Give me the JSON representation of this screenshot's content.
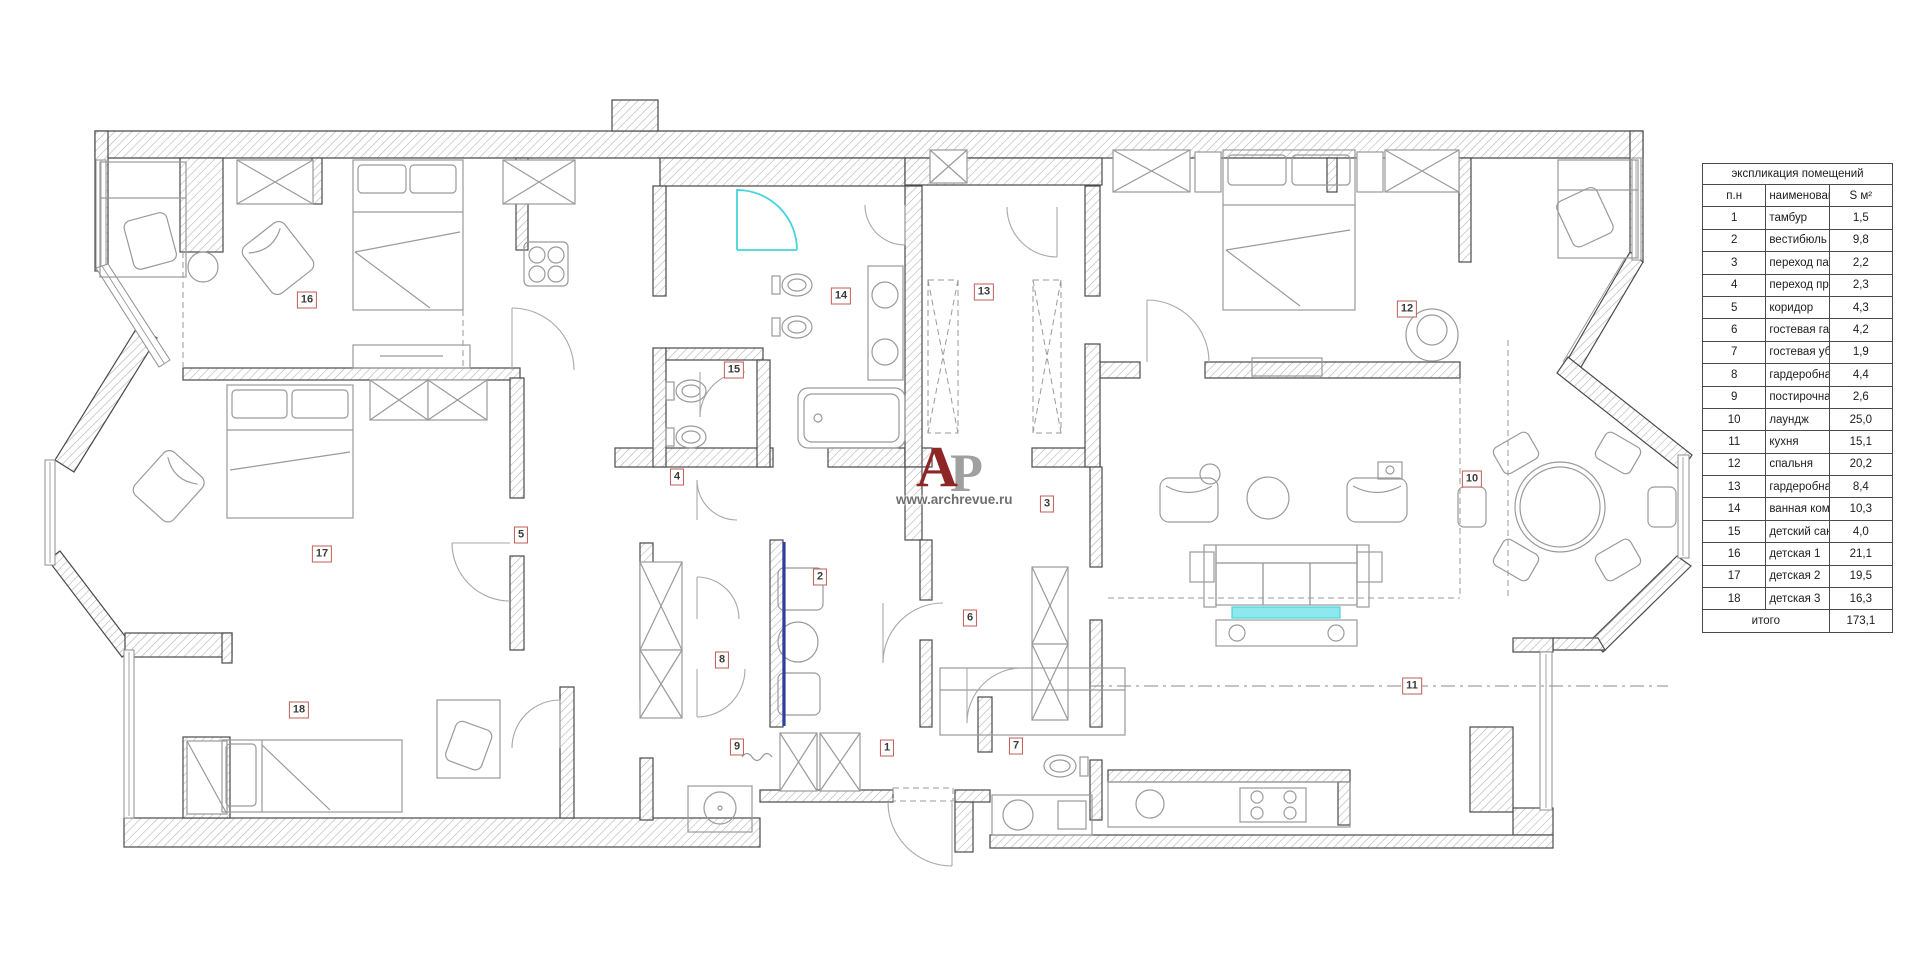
{
  "watermark": {
    "letter_primary": "А",
    "letter_secondary": "Р",
    "url": "www.archrevue.ru"
  },
  "legend": {
    "title": "экспликация помещений",
    "col_num": "п.н",
    "col_name": "наименование",
    "col_area": "S м²",
    "rows": [
      {
        "n": "1",
        "name": "тамбур",
        "area": "1,5"
      },
      {
        "n": "2",
        "name": "вестибюль",
        "area": "9,8"
      },
      {
        "n": "3",
        "name": "переход парадный",
        "area": "2,2"
      },
      {
        "n": "4",
        "name": "переход приватный",
        "area": "2,3"
      },
      {
        "n": "5",
        "name": "коридор",
        "area": "4,3"
      },
      {
        "n": "6",
        "name": "гостевая гардеробная",
        "area": "4,2"
      },
      {
        "n": "7",
        "name": "гостевая уборная",
        "area": "1,9"
      },
      {
        "n": "8",
        "name": "гардеробная",
        "area": "4,4"
      },
      {
        "n": "9",
        "name": "постирочная",
        "area": "2,6"
      },
      {
        "n": "10",
        "name": "лаундж",
        "area": "25,0"
      },
      {
        "n": "11",
        "name": "кухня",
        "area": "15,1"
      },
      {
        "n": "12",
        "name": "спальня",
        "area": "20,2"
      },
      {
        "n": "13",
        "name": "гардеробная хозяйская",
        "area": "8,4"
      },
      {
        "n": "14",
        "name": "ванная комната",
        "area": "10,3"
      },
      {
        "n": "15",
        "name": "детский санузел",
        "area": "4,0"
      },
      {
        "n": "16",
        "name": "детская 1",
        "area": "21,1"
      },
      {
        "n": "17",
        "name": "детская 2",
        "area": "19,5"
      },
      {
        "n": "18",
        "name": "детская 3",
        "area": "16,3"
      }
    ],
    "total_label": "итого",
    "total_area": "173,1"
  },
  "plan": {
    "labels": [
      {
        "n": "1",
        "x": 887,
        "y": 748
      },
      {
        "n": "2",
        "x": 820,
        "y": 577
      },
      {
        "n": "3",
        "x": 1047,
        "y": 504
      },
      {
        "n": "4",
        "x": 677,
        "y": 477
      },
      {
        "n": "5",
        "x": 521,
        "y": 535
      },
      {
        "n": "6",
        "x": 970,
        "y": 618
      },
      {
        "n": "7",
        "x": 1016,
        "y": 746
      },
      {
        "n": "8",
        "x": 722,
        "y": 660
      },
      {
        "n": "9",
        "x": 737,
        "y": 747
      },
      {
        "n": "10",
        "x": 1472,
        "y": 479
      },
      {
        "n": "11",
        "x": 1412,
        "y": 686
      },
      {
        "n": "12",
        "x": 1407,
        "y": 309
      },
      {
        "n": "13",
        "x": 984,
        "y": 292
      },
      {
        "n": "14",
        "x": 841,
        "y": 296
      },
      {
        "n": "15",
        "x": 734,
        "y": 370
      },
      {
        "n": "16",
        "x": 307,
        "y": 300
      },
      {
        "n": "17",
        "x": 322,
        "y": 554
      },
      {
        "n": "18",
        "x": 299,
        "y": 710
      }
    ],
    "colors": {
      "wall_outline": "#4a4a4a",
      "hatch": "#b4b4b4",
      "furniture": "#9a9a9a",
      "label_border": "#c05c55",
      "label_text": "#3a3a3a",
      "cyan": "#45d5dd",
      "cyan_fill": "#8ee9ef",
      "blue": "#2f3f9f",
      "red_logo": "#8f2626",
      "grey_logo": "#a0a0a0"
    }
  }
}
